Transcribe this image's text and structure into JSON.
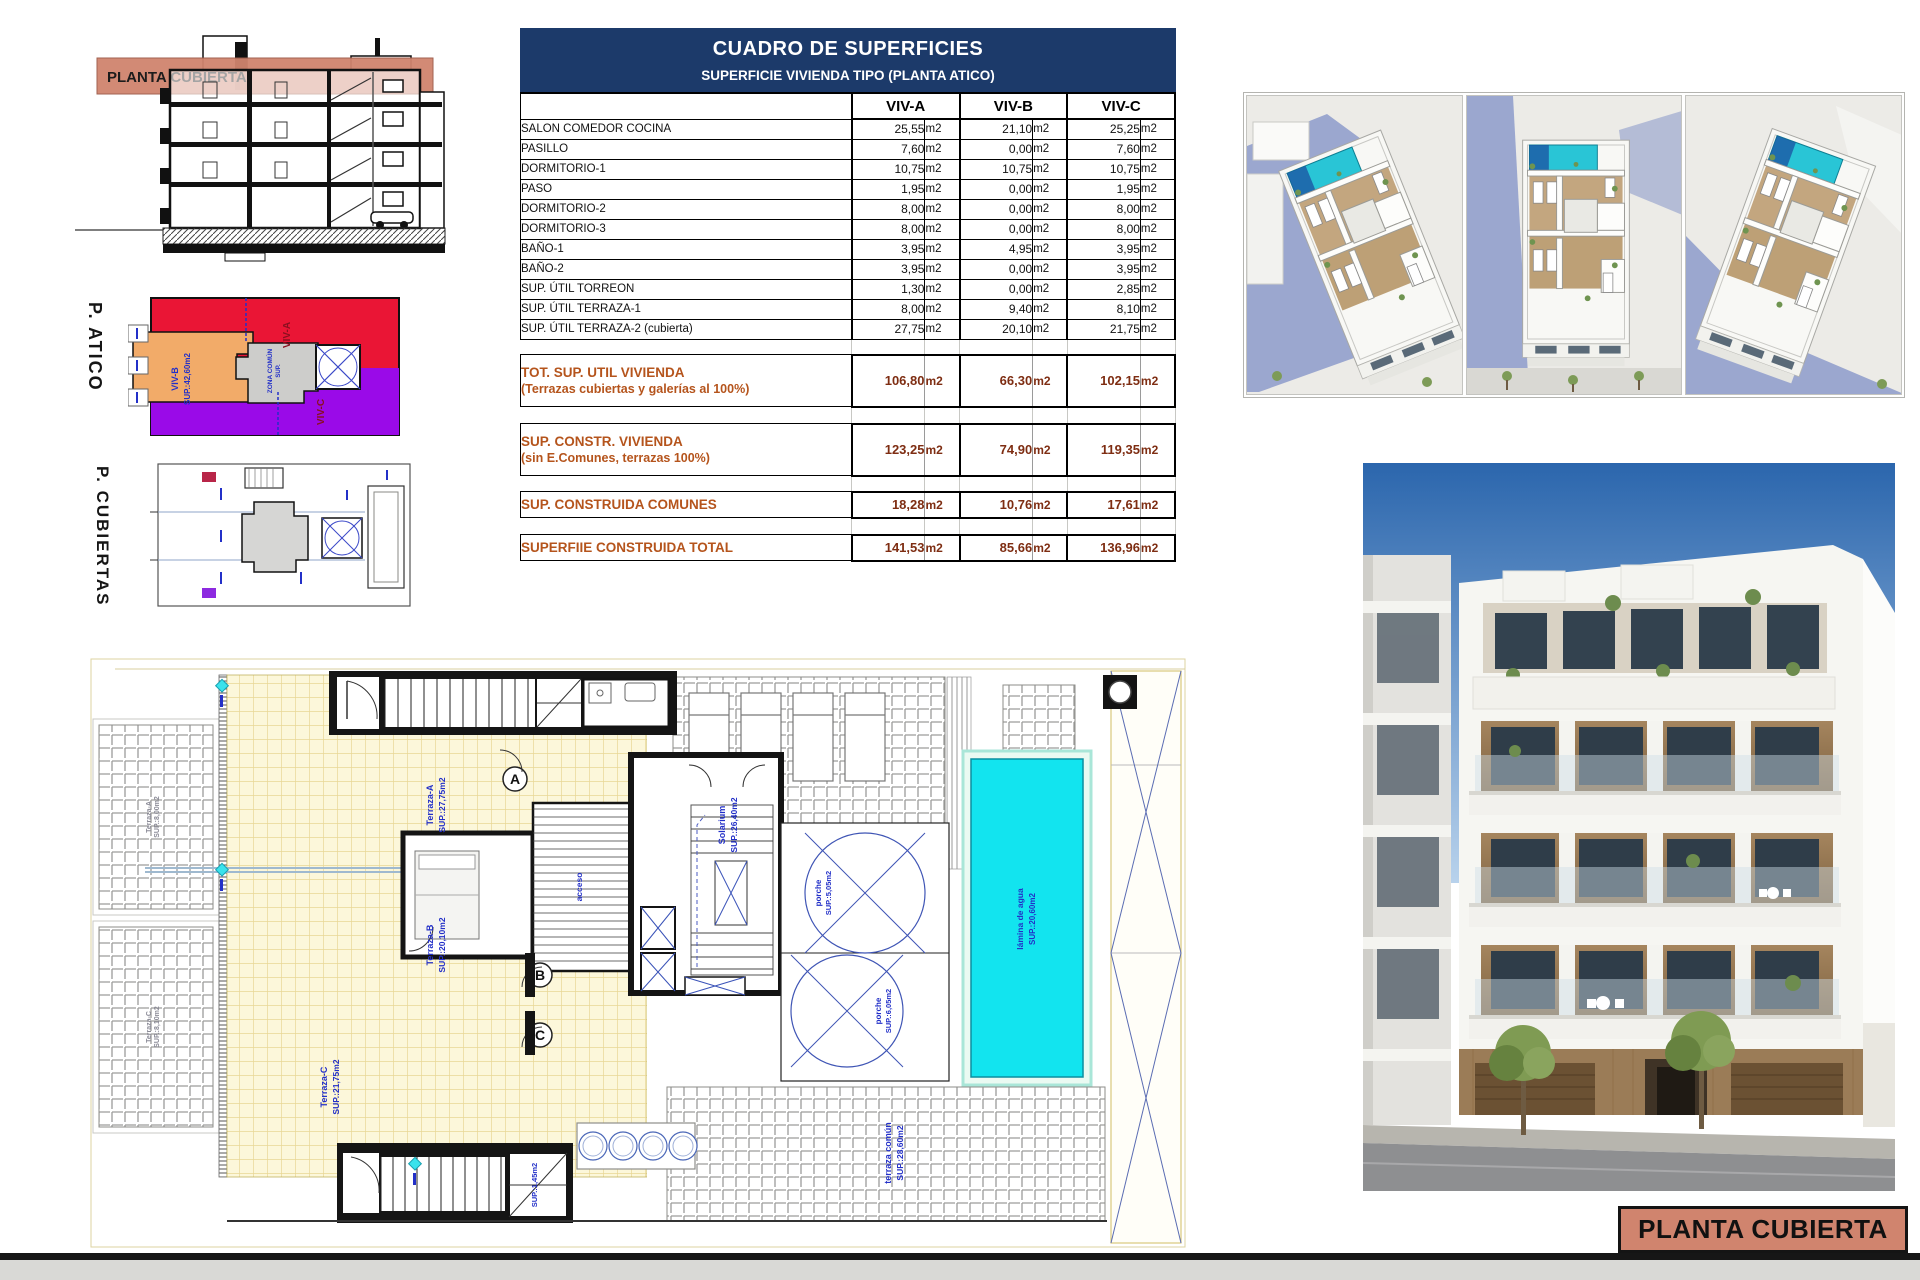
{
  "page": {
    "bottom_title": "PLANTA CUBIERTA"
  },
  "section": {
    "band_label": "PLANTA CUBIERTA"
  },
  "side_labels": {
    "atico": "P. ATICO",
    "cubiertas": "P. CUBIERTAS"
  },
  "atico_plan": {
    "viv_a": "VIV-A",
    "viv_b": "VIV-B",
    "viv_b_sup": "SUP.:42,60m2",
    "viv_c": "VIV-C",
    "zona_comun": "ZONA COMÚN",
    "zona_sup": "SUP."
  },
  "table": {
    "title": "CUADRO DE SUPERFICIES",
    "subtitle": "SUPERFICIE VIVIENDA TIPO  (PLANTA ATICO)",
    "columns": [
      "VIV-A",
      "VIV-B",
      "VIV-C"
    ],
    "unit": "m2",
    "rows": [
      {
        "label": "SALON COMEDOR COCINA",
        "a": "25,55",
        "b": "21,10",
        "c": "25,25"
      },
      {
        "label": "PASILLO",
        "a": "7,60",
        "b": "0,00",
        "c": "7,60"
      },
      {
        "label": "DORMITORIO-1",
        "a": "10,75",
        "b": "10,75",
        "c": "10,75"
      },
      {
        "label": "PASO",
        "a": "1,95",
        "b": "0,00",
        "c": "1,95"
      },
      {
        "label": "DORMITORIO-2",
        "a": "8,00",
        "b": "0,00",
        "c": "8,00"
      },
      {
        "label": "DORMITORIO-3",
        "a": "8,00",
        "b": "0,00",
        "c": "8,00"
      },
      {
        "label": "BAÑO-1",
        "a": "3,95",
        "b": "4,95",
        "c": "3,95"
      },
      {
        "label": "BAÑO-2",
        "a": "3,95",
        "b": "0,00",
        "c": "3,95"
      },
      {
        "label": "SUP. ÚTIL TORREON",
        "a": "1,30",
        "b": "0,00",
        "c": "2,85"
      },
      {
        "label": "SUP. ÚTIL TERRAZA-1",
        "a": "8,00",
        "b": "9,40",
        "c": "8,10"
      },
      {
        "label": "SUP. ÚTIL TERRAZA-2 (cubierta)",
        "a": "27,75",
        "b": "20,10",
        "c": "21,75"
      }
    ],
    "summaries": [
      {
        "line1": "TOT. SUP. UTIL VIVIENDA",
        "line2": "(Terrazas cubiertas y galerías al 100%)",
        "a": "106,80",
        "b": "66,30",
        "c": "102,15"
      },
      {
        "line1": "SUP. CONSTR. VIVIENDA",
        "line2": "(sin E.Comunes, terrazas 100%)",
        "a": "123,25",
        "b": "74,90",
        "c": "119,35"
      },
      {
        "line1": "SUP. CONSTRUIDA COMUNES",
        "line2": "",
        "a": "18,28",
        "b": "10,76",
        "c": "17,61"
      },
      {
        "line1": "SUPERFIIE CONSTRUIDA TOTAL",
        "line2": "",
        "a": "141,53",
        "b": "85,66",
        "c": "136,96"
      }
    ]
  },
  "plan": {
    "letters": {
      "a": "A",
      "b": "B",
      "c": "C"
    },
    "labels": {
      "terraza_a": "Terraza-A",
      "terraza_a_sup": "SUP.:27,75m2",
      "terraza_b": "Terraza-B",
      "terraza_b_sup": "SUP.:20,10m2",
      "terraza_c": "Terraza-C",
      "terraza_c_sup": "SUP.:21,75m2",
      "solarium": "Solarium",
      "solarium_sup": "SUP.:26,40m2",
      "porche1": "porche",
      "porche1_sup": "SUP.:5,05m2",
      "porche2": "porche",
      "porche2_sup": "SUP.:6,05m2",
      "pool": "lámina de agua",
      "pool_sup": "SUP.:20,60m2",
      "comun": "terraza común",
      "comun_sup": "SUP.:28,60m2",
      "acceso": "acceso",
      "stair_sup": "SUP.:1,45m2",
      "pergola_top_1": "Terraza-A",
      "pergola_top_2": "SUP.:8,00m2",
      "pergola_bot_1": "Terraza-C",
      "pergola_bot_2": "SUP.:8,10m2"
    }
  }
}
